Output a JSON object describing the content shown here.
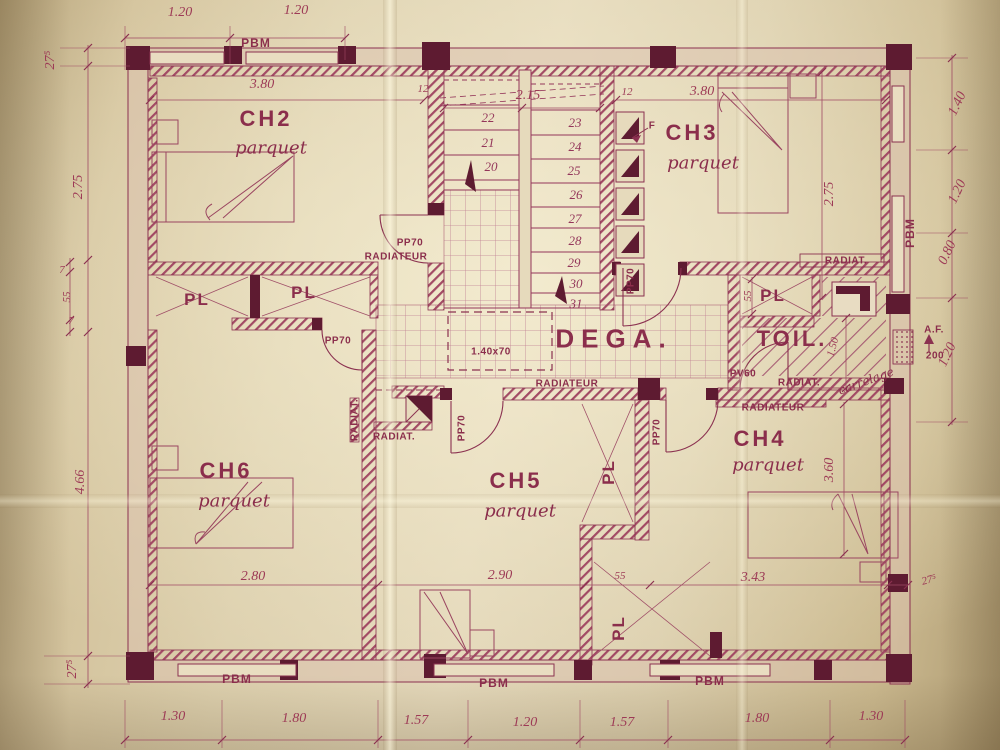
{
  "drawing": {
    "ink": "#8b2e4c",
    "ink_dark": "#5e1b31",
    "paper": "#d5c49e",
    "rooms": [
      "CH2",
      "CH3",
      "CH4",
      "CH5",
      "CH6",
      "DEGA.",
      "TOIL."
    ]
  },
  "labels": [
    {
      "name": "dim-top-120-a",
      "text": "1.20",
      "x": 180,
      "y": 13,
      "cls": "dim"
    },
    {
      "name": "dim-top-120-b",
      "text": "1.20",
      "x": 296,
      "y": 11,
      "cls": "dim"
    },
    {
      "name": "tag-pbm-top",
      "text": "PBM",
      "x": 256,
      "y": 43,
      "cls": "tag"
    },
    {
      "name": "dim-ch2-380",
      "text": "3.80",
      "x": 262,
      "y": 85,
      "cls": "dim"
    },
    {
      "name": "dim-12-left",
      "text": "12",
      "x": 423,
      "y": 89,
      "cls": "dimsm"
    },
    {
      "name": "dim-stair-215",
      "text": "2.15",
      "x": 528,
      "y": 96,
      "cls": "dim"
    },
    {
      "name": "dim-12-right",
      "text": "12",
      "x": 627,
      "y": 92,
      "cls": "dimsm"
    },
    {
      "name": "dim-ch3-380",
      "text": "3.80",
      "x": 702,
      "y": 92,
      "cls": "dim"
    },
    {
      "name": "dim-left-wall-275",
      "text": "27⁵",
      "x": 51,
      "y": 60,
      "rot": -90,
      "cls": "dim"
    },
    {
      "name": "dim-left-275",
      "text": "2.75",
      "x": 79,
      "y": 187,
      "rot": -90,
      "cls": "dim"
    },
    {
      "name": "dim-left-7a",
      "text": "7",
      "x": 62,
      "y": 270,
      "cls": "dimsm"
    },
    {
      "name": "dim-left-55",
      "text": "55",
      "x": 67,
      "y": 297,
      "rot": -90,
      "cls": "dimsm"
    },
    {
      "name": "dim-left-7b",
      "text": "7",
      "x": 71,
      "y": 321,
      "cls": "dimsm"
    },
    {
      "name": "dim-left-466",
      "text": "4.66",
      "x": 81,
      "y": 482,
      "rot": -90,
      "cls": "dim"
    },
    {
      "name": "dim-left-wall-275-b",
      "text": "27⁵",
      "x": 73,
      "y": 669,
      "rot": -90,
      "cls": "dim"
    },
    {
      "name": "dim-right-140",
      "text": "1.40",
      "x": 958,
      "y": 104,
      "rot": -65,
      "cls": "dim"
    },
    {
      "name": "dim-right-120-a",
      "text": "1.20",
      "x": 958,
      "y": 192,
      "rot": -65,
      "cls": "dim"
    },
    {
      "name": "dim-right-080",
      "text": "0.80",
      "x": 948,
      "y": 253,
      "rot": -65,
      "cls": "dim"
    },
    {
      "name": "dim-right-120-b",
      "text": "1.20",
      "x": 948,
      "y": 355,
      "rot": -65,
      "cls": "dim"
    },
    {
      "name": "tag-pbm-right",
      "text": "PBM",
      "x": 910,
      "y": 233,
      "rot": -90,
      "cls": "tag"
    },
    {
      "name": "tag-af",
      "text": "A.F.",
      "x": 934,
      "y": 330,
      "cls": "tagsm"
    },
    {
      "name": "tag-af-200",
      "text": "200",
      "x": 935,
      "y": 356,
      "cls": "tagsm"
    },
    {
      "name": "dim-ch3-275",
      "text": "2.75",
      "x": 830,
      "y": 194,
      "rot": -90,
      "cls": "dim"
    },
    {
      "name": "dim-toil-150",
      "text": "1.50",
      "x": 833,
      "y": 347,
      "rot": -75,
      "cls": "dimsm"
    },
    {
      "name": "dim-pl-toil-55",
      "text": "55",
      "x": 748,
      "y": 296,
      "rot": -90,
      "cls": "dimsm"
    },
    {
      "name": "dim-ch4-360",
      "text": "3.60",
      "x": 830,
      "y": 470,
      "rot": -90,
      "cls": "dim"
    },
    {
      "name": "dim-ch6-280",
      "text": "2.80",
      "x": 253,
      "y": 577,
      "cls": "dim"
    },
    {
      "name": "dim-ch5-290",
      "text": "2.90",
      "x": 500,
      "y": 576,
      "cls": "dim"
    },
    {
      "name": "dim-pl-55",
      "text": "55",
      "x": 620,
      "y": 576,
      "cls": "dimsm"
    },
    {
      "name": "dim-ch4-343",
      "text": "3.43",
      "x": 753,
      "y": 578,
      "cls": "dim"
    },
    {
      "name": "dim-wall-275-c",
      "text": "27⁵",
      "x": 929,
      "y": 580,
      "rot": -15,
      "cls": "dimsm"
    },
    {
      "name": "dim-bot-130-a",
      "text": "1.30",
      "x": 173,
      "y": 717,
      "cls": "dim"
    },
    {
      "name": "dim-bot-180-a",
      "text": "1.80",
      "x": 294,
      "y": 719,
      "cls": "dim"
    },
    {
      "name": "dim-bot-157-a",
      "text": "1.57",
      "x": 416,
      "y": 721,
      "cls": "dim"
    },
    {
      "name": "dim-bot-120",
      "text": "1.20",
      "x": 525,
      "y": 723,
      "cls": "dim"
    },
    {
      "name": "dim-bot-157-b",
      "text": "1.57",
      "x": 622,
      "y": 723,
      "cls": "dim"
    },
    {
      "name": "dim-bot-180-b",
      "text": "1.80",
      "x": 757,
      "y": 719,
      "cls": "dim"
    },
    {
      "name": "dim-bot-130-b",
      "text": "1.30",
      "x": 871,
      "y": 717,
      "cls": "dim"
    },
    {
      "name": "tag-pbm-bottom-1",
      "text": "PBM",
      "x": 237,
      "y": 679,
      "cls": "tag"
    },
    {
      "name": "tag-pbm-bottom-2",
      "text": "PBM",
      "x": 494,
      "y": 683,
      "cls": "tag"
    },
    {
      "name": "tag-pbm-bottom-3",
      "text": "PBM",
      "x": 710,
      "y": 681,
      "cls": "tag"
    },
    {
      "name": "room-ch2",
      "text": "CH2",
      "x": 266,
      "y": 119,
      "cls": "room"
    },
    {
      "name": "room-ch2-floor",
      "text": "parquet",
      "x": 271,
      "y": 148,
      "cls": "script"
    },
    {
      "name": "room-ch3",
      "text": "CH3",
      "x": 692,
      "y": 133,
      "cls": "room"
    },
    {
      "name": "room-ch3-floor",
      "text": "parquet",
      "x": 703,
      "y": 163,
      "cls": "script"
    },
    {
      "name": "room-ch6",
      "text": "CH6",
      "x": 226,
      "y": 471,
      "cls": "room"
    },
    {
      "name": "room-ch6-floor",
      "text": "parquet",
      "x": 234,
      "y": 501,
      "cls": "script"
    },
    {
      "name": "room-ch5",
      "text": "CH5",
      "x": 516,
      "y": 481,
      "cls": "room"
    },
    {
      "name": "room-ch5-floor",
      "text": "parquet",
      "x": 520,
      "y": 511,
      "cls": "script"
    },
    {
      "name": "room-ch4",
      "text": "CH4",
      "x": 760,
      "y": 439,
      "cls": "room"
    },
    {
      "name": "room-ch4-floor",
      "text": "parquet",
      "x": 768,
      "y": 465,
      "cls": "script"
    },
    {
      "name": "room-dega",
      "text": "DEGA.",
      "x": 614,
      "y": 339,
      "cls": "room-lg"
    },
    {
      "name": "room-toil",
      "text": "TOIL.",
      "x": 792,
      "y": 339,
      "cls": "room"
    },
    {
      "name": "closet-pl-1",
      "text": "PL",
      "x": 197,
      "y": 300,
      "cls": "pl"
    },
    {
      "name": "closet-pl-2",
      "text": "PL",
      "x": 304,
      "y": 293,
      "cls": "pl"
    },
    {
      "name": "closet-pl-toil",
      "text": "PL",
      "x": 773,
      "y": 296,
      "cls": "pl"
    },
    {
      "name": "closet-pl-mid",
      "text": "PL",
      "x": 609,
      "y": 472,
      "rot": -90,
      "cls": "pl"
    },
    {
      "name": "closet-pl-bottom",
      "text": "PL",
      "x": 619,
      "y": 628,
      "rot": -90,
      "cls": "pl"
    },
    {
      "name": "door-pp70-ch2",
      "text": "PP70",
      "x": 410,
      "y": 243,
      "cls": "tagsm"
    },
    {
      "name": "door-pp70-ch6",
      "text": "PP70",
      "x": 338,
      "y": 341,
      "cls": "tagsm"
    },
    {
      "name": "door-pp70-ch3",
      "text": "PP70",
      "x": 631,
      "y": 281,
      "rot": -90,
      "cls": "tagsm"
    },
    {
      "name": "door-pp70-ch5",
      "text": "PP70",
      "x": 462,
      "y": 428,
      "rot": -90,
      "cls": "tagsm"
    },
    {
      "name": "door-pp70-ch4",
      "text": "PP70",
      "x": 657,
      "y": 432,
      "rot": -90,
      "cls": "tagsm"
    },
    {
      "name": "radiator-ch2",
      "text": "RADIATEUR",
      "x": 396,
      "y": 257,
      "cls": "tagsm"
    },
    {
      "name": "radiator-dega",
      "text": "RADIATEUR",
      "x": 567,
      "y": 384,
      "cls": "tagsm"
    },
    {
      "name": "radiator-ch4",
      "text": "RADIATEUR",
      "x": 773,
      "y": 408,
      "cls": "tagsm"
    },
    {
      "name": "radiator-ch3",
      "text": "RADIAT.",
      "x": 846,
      "y": 261,
      "cls": "tagsm"
    },
    {
      "name": "radiator-toil",
      "text": "RADIAT.",
      "x": 799,
      "y": 383,
      "cls": "tagsm"
    },
    {
      "name": "radiator-ch6-b",
      "text": "RADIAT.",
      "x": 394,
      "y": 437,
      "cls": "tagsm"
    },
    {
      "name": "radiator-ch6-a",
      "text": "RADIAT.",
      "x": 355,
      "y": 420,
      "rot": -90,
      "cls": "tagsm"
    },
    {
      "name": "door-pv60",
      "text": "PV60",
      "x": 743,
      "y": 374,
      "cls": "tagsm"
    },
    {
      "name": "hatch-trap-dim",
      "text": "1.40x70",
      "x": 491,
      "y": 352,
      "cls": "tagsm"
    },
    {
      "name": "flue-f",
      "text": "F",
      "x": 652,
      "y": 126,
      "cls": "tagsm"
    },
    {
      "name": "toil-floor-note",
      "text": "carrelage",
      "x": 866,
      "y": 381,
      "rot": -20,
      "cls": "scriptsm"
    },
    {
      "name": "stair-step-22",
      "text": "22",
      "x": 488,
      "y": 118,
      "cls": "stno"
    },
    {
      "name": "stair-step-21",
      "text": "21",
      "x": 488,
      "y": 143,
      "cls": "stno"
    },
    {
      "name": "stair-step-20",
      "text": "20",
      "x": 491,
      "y": 167,
      "cls": "stno"
    },
    {
      "name": "stair-step-23",
      "text": "23",
      "x": 575,
      "y": 123,
      "cls": "stno"
    },
    {
      "name": "stair-step-24",
      "text": "24",
      "x": 575,
      "y": 147,
      "cls": "stno"
    },
    {
      "name": "stair-step-25",
      "text": "25",
      "x": 574,
      "y": 171,
      "cls": "stno"
    },
    {
      "name": "stair-step-26",
      "text": "26",
      "x": 576,
      "y": 195,
      "cls": "stno"
    },
    {
      "name": "stair-step-27",
      "text": "27",
      "x": 575,
      "y": 219,
      "cls": "stno"
    },
    {
      "name": "stair-step-28",
      "text": "28",
      "x": 575,
      "y": 241,
      "cls": "stno"
    },
    {
      "name": "stair-step-29",
      "text": "29",
      "x": 574,
      "y": 263,
      "cls": "stno"
    },
    {
      "name": "stair-step-30",
      "text": "30",
      "x": 576,
      "y": 284,
      "cls": "stno"
    },
    {
      "name": "stair-step-31",
      "text": "31",
      "x": 576,
      "y": 304,
      "cls": "stno"
    }
  ]
}
